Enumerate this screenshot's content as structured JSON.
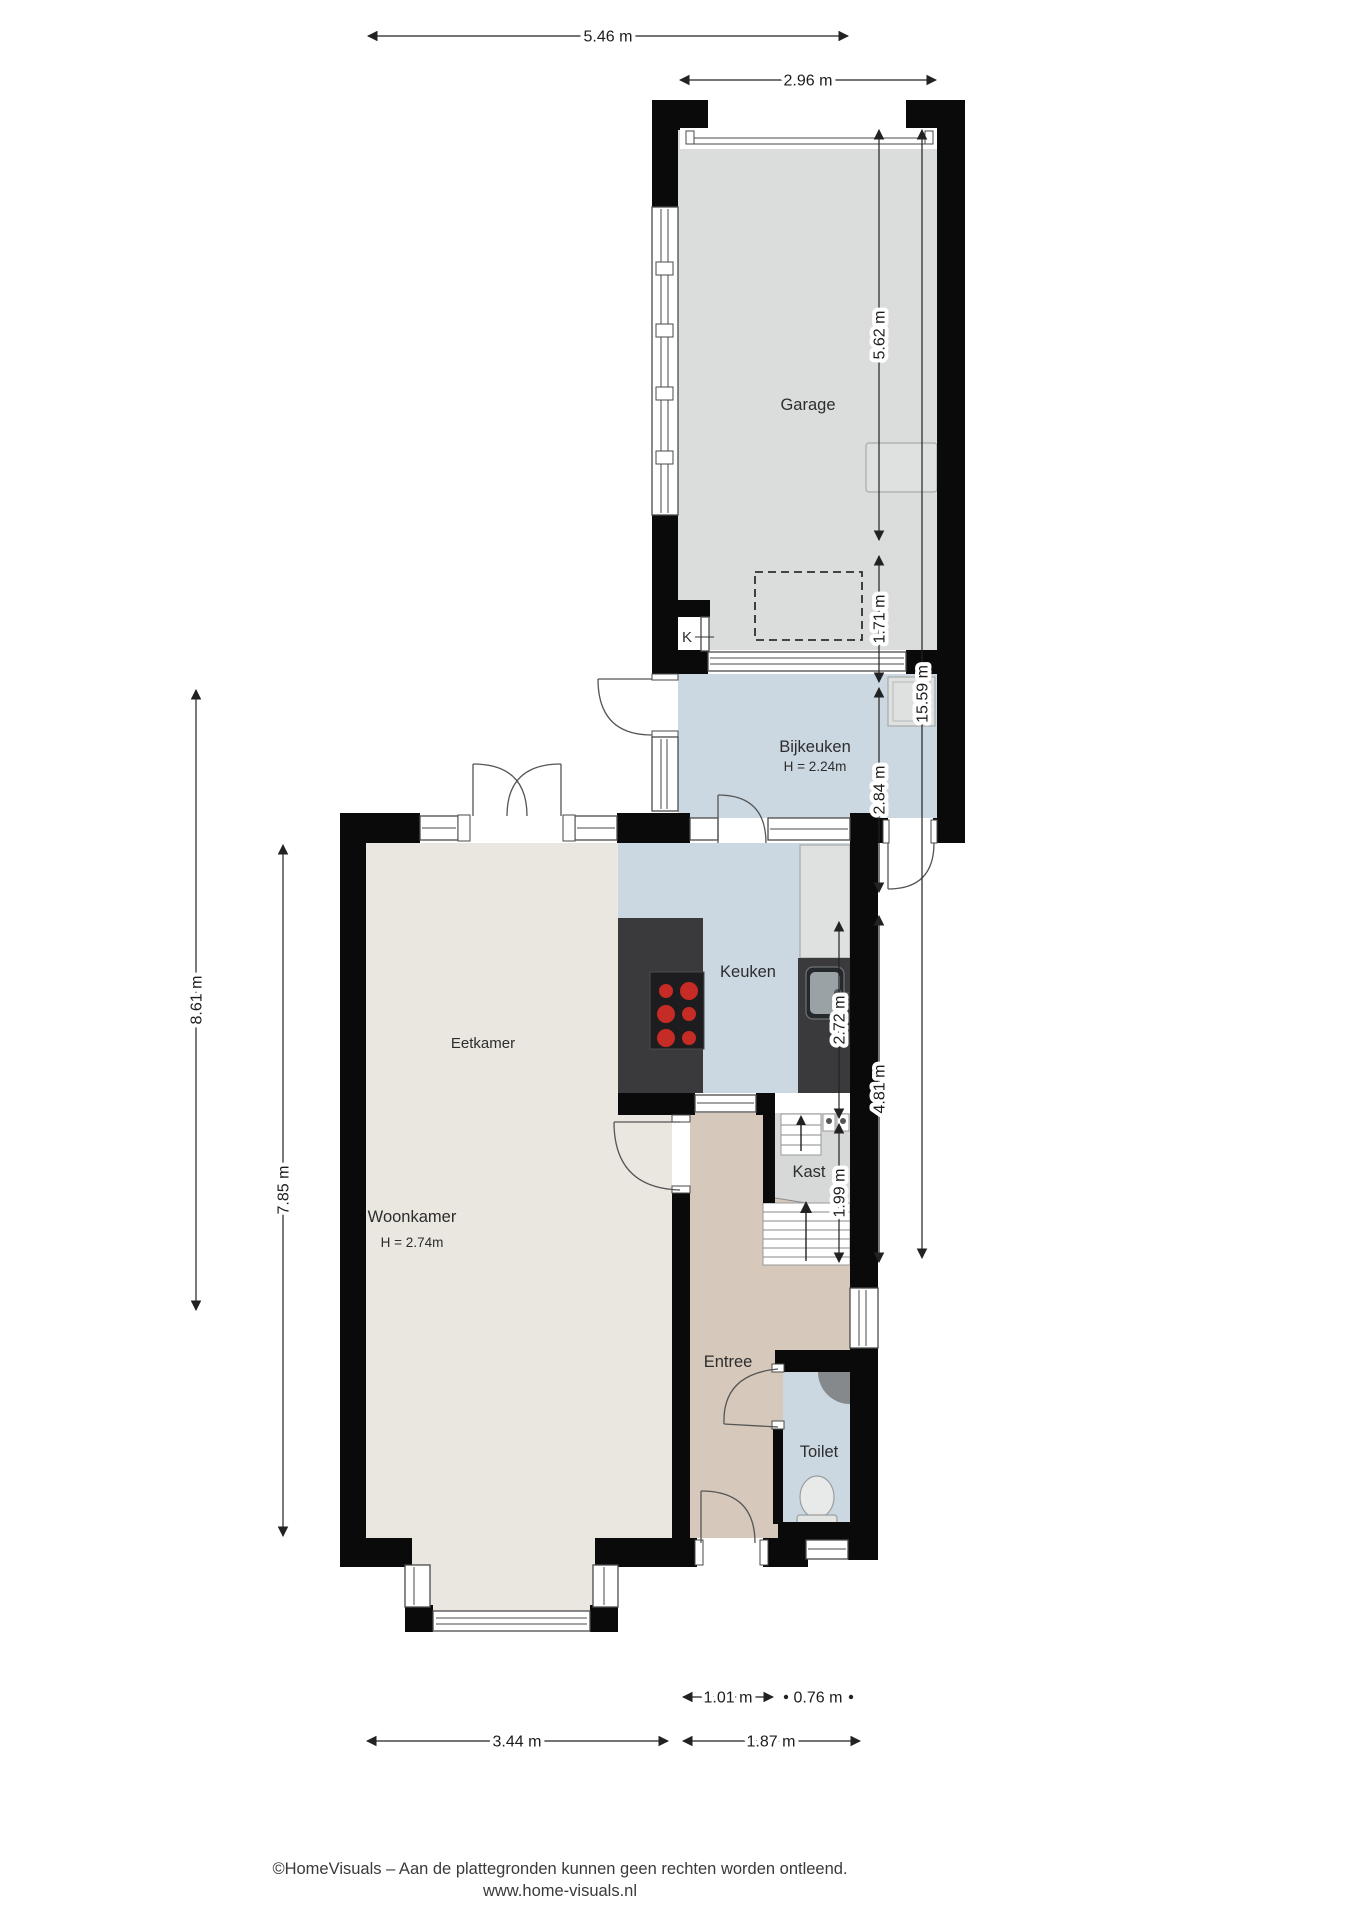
{
  "rooms": {
    "garage": {
      "label": "Garage"
    },
    "bijkeuken": {
      "label": "Bijkeuken",
      "height": "H = 2.24m"
    },
    "keuken": {
      "label": "Keuken"
    },
    "eetkamer": {
      "label": "Eetkamer"
    },
    "woonkamer": {
      "label": "Woonkamer",
      "height": "H = 2.74m"
    },
    "kast": {
      "label": "Kast"
    },
    "entree": {
      "label": "Entree"
    },
    "toilet": {
      "label": "Toilet"
    },
    "k": {
      "label": "K"
    }
  },
  "dims": {
    "top_main": "5.46 m",
    "top_garage": "2.96 m",
    "right_garage": "5.62 m",
    "right_bijkeuken": "1.71 m",
    "right_total": "15.59 m",
    "right_keuken": "2.84 m",
    "right_kast": "2.72 m",
    "right_hall": "4.81 m",
    "right_toilet": "1.99 m",
    "left_outer": "8.61 m",
    "left_inner": "7.85 m",
    "bottom_door": "1.01 m",
    "bottom_small": "0.76 m",
    "bottom_living": "3.44 m",
    "bottom_hall": "1.87 m"
  },
  "footer": {
    "line1": "©HomeVisuals – Aan de plattegronden kunnen geen rechten worden ontleend.",
    "line2": "www.home-visuals.nl"
  },
  "colors": {
    "wall": "#0a0a0a",
    "garage_floor": "#dbdddc",
    "wet_floor": "#cbd8e2",
    "living_floor": "#eae6e0",
    "hall_floor": "#d6c9bb",
    "kast_floor": "#d7d9d8",
    "counter": "#3a3a3c",
    "stove": "#1d1d1f",
    "burner": "#c62b25",
    "fixture_gray": "#dfe1e0"
  }
}
